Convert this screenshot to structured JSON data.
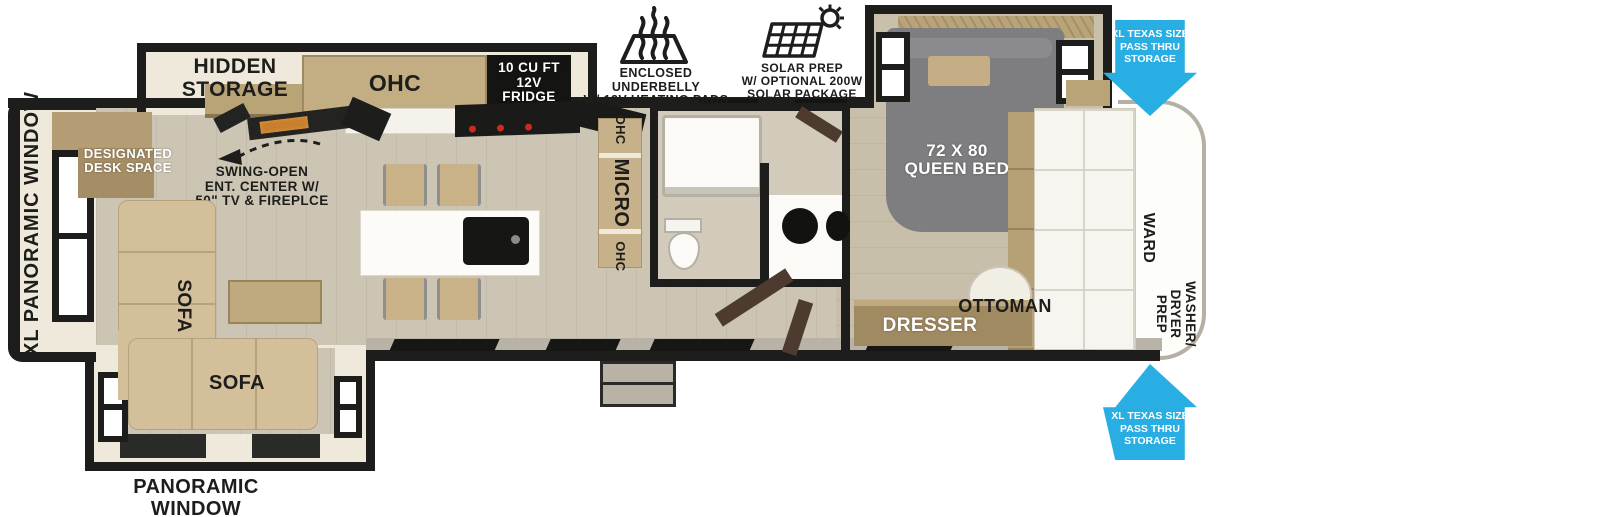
{
  "diagram": {
    "type": "rv-floorplan",
    "view": "top-down",
    "colors": {
      "wall": "#1d1d1b",
      "floor": "#ccc5b3",
      "bedroom_floor": "#c8bfab",
      "slide_interior": "#efe9dc",
      "wall_gray": "#b9b3a7",
      "wood": "#b9a478",
      "sofa_tan": "#d4bf9b",
      "bed_gray": "#7e7e81",
      "accent_blue": "#29aee3",
      "fireplace_orange": "#c87f2e",
      "burner_red": "#cc2a20",
      "door_brown": "#4d3b2f"
    }
  },
  "labels": {
    "xl_panoramic_window": "XL PANORAMIC WINDOW",
    "hidden_storage": {
      "lines": [
        "HIDDEN",
        "STORAGE"
      ]
    },
    "designated_desk": {
      "lines": [
        "DESIGNATED",
        "DESK SPACE"
      ]
    },
    "ent_center": {
      "lines": [
        "SWING-OPEN",
        "ENT. CENTER W/",
        "50\" TV & FIREPLCE"
      ]
    },
    "ohc": "OHC",
    "fridge": {
      "lines": [
        "10 CU FT",
        "12V",
        "FRIDGE"
      ]
    },
    "underbelly": {
      "lines": [
        "ENCLOSED UNDERBELLY",
        "W/ 12V HEATING PADS"
      ]
    },
    "solar": {
      "lines": [
        "SOLAR PREP",
        "W/ OPTIONAL 200W",
        "SOLAR PACKAGE"
      ]
    },
    "micro_strip": {
      "top": "OHC",
      "middle": "MICRO",
      "bottom": "OHC"
    },
    "queen_bed": {
      "lines": [
        "72 X 80",
        "QUEEN BED"
      ]
    },
    "pass_thru": {
      "lines": [
        "XL TEXAS SIZE",
        "PASS THRU",
        "STORAGE"
      ]
    },
    "sofa": "SOFA",
    "ottoman": "OTTOMAN",
    "dresser": "DRESSER",
    "ward": "WARD",
    "washer_dryer": {
      "lines": [
        "WASHER/",
        "DRYER",
        "PREP"
      ]
    },
    "panoramic_window": {
      "lines": [
        "PANORAMIC",
        "WINDOW"
      ]
    }
  }
}
